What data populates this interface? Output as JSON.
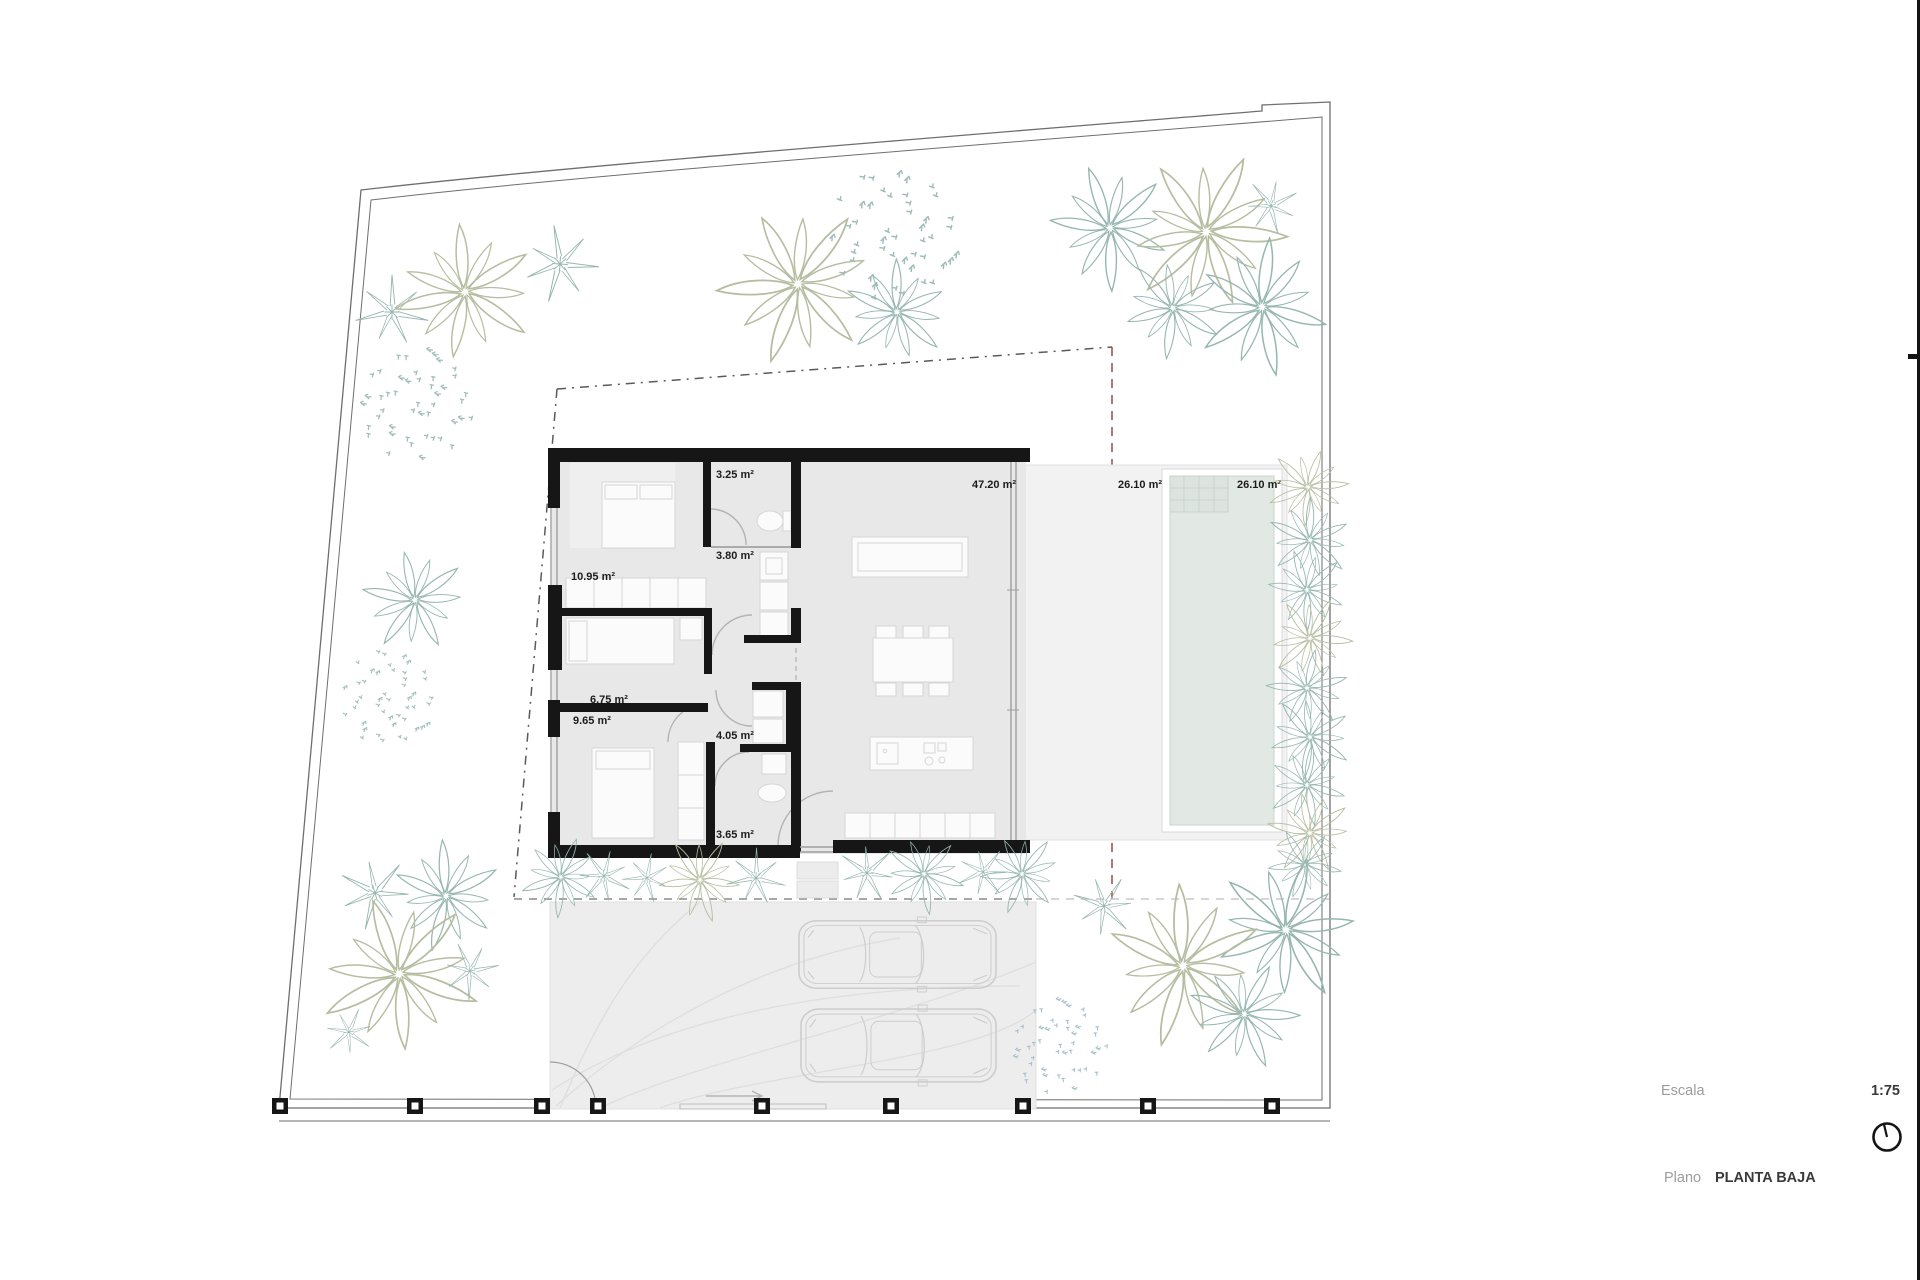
{
  "plan": {
    "room_labels": {
      "bedroom1": "10.95 m²",
      "bath1": "3.25 m²",
      "hall": "3.80 m²",
      "bedroom2": "6.75 m²",
      "bedroom3": "9.65 m²",
      "bath2": "4.05 m²",
      "bath3": "3.65 m²",
      "living": "47.20 m²",
      "terrace": "26.10 m²",
      "pool": "26.10 m²"
    }
  },
  "title_block": {
    "escala_label": "Escala",
    "escala_value": "1:75",
    "plano_label": "Plano",
    "plano_value": "PLANTA BAJA"
  },
  "colors": {
    "wall": "#161616",
    "room_fill": "#e8e8e8",
    "rug_fill": "#efefef",
    "terrace_fill": "#f2f2f2",
    "pool_water": "#e2e8e4",
    "pool_border": "#c9d4cd",
    "driveway_fill": "#ededed",
    "furniture_fill": "#fbfbfb",
    "furniture_stroke": "#d6d6d6",
    "door_arc": "#b3b3b3",
    "window_line": "#9e9e9e",
    "boundary": "#6e6e6e",
    "setback_dash": "#5a5a5a",
    "setback_dash_red": "#9a4a43",
    "setback_dash_light": "#c9c9c9",
    "car_outline": "#cdcdcd",
    "drive_guide": "#dedede",
    "tree_olive": "#b6bda0",
    "tree_teal": "#96b6b0",
    "shrub_teal": "#9fbcba",
    "shrub_blue": "#a4bfca",
    "muted_text": "#9c9c9c",
    "dark_text": "#3a3a3a"
  },
  "fence_posts": {
    "y": 1106,
    "xs": [
      280,
      415,
      542,
      598,
      762,
      891,
      1023,
      1148,
      1272
    ]
  },
  "cars": [
    {
      "x": 798,
      "y": 917,
      "w": 199,
      "h": 75
    },
    {
      "x": 800,
      "y": 1005,
      "w": 197,
      "h": 81
    }
  ],
  "trees": [
    {
      "type": "star",
      "x": 392,
      "y": 312,
      "r": 42,
      "color": "teal"
    },
    {
      "type": "palm",
      "x": 465,
      "y": 292,
      "r": 70,
      "color": "olive"
    },
    {
      "type": "star",
      "x": 560,
      "y": 264,
      "r": 44,
      "color": "teal"
    },
    {
      "type": "shrub",
      "x": 418,
      "y": 402,
      "r": 62,
      "color": "shrub_teal"
    },
    {
      "type": "palm",
      "x": 798,
      "y": 284,
      "r": 80,
      "color": "olive"
    },
    {
      "type": "shrub",
      "x": 897,
      "y": 237,
      "r": 72,
      "color": "shrub_teal"
    },
    {
      "type": "palm",
      "x": 897,
      "y": 312,
      "r": 52,
      "color": "teal"
    },
    {
      "type": "palm",
      "x": 1110,
      "y": 228,
      "r": 62,
      "color": "teal"
    },
    {
      "type": "palm",
      "x": 1206,
      "y": 232,
      "r": 80,
      "color": "olive"
    },
    {
      "type": "star",
      "x": 1271,
      "y": 206,
      "r": 32,
      "color": "teal"
    },
    {
      "type": "palm",
      "x": 1173,
      "y": 308,
      "r": 50,
      "color": "teal"
    },
    {
      "type": "palm",
      "x": 1262,
      "y": 307,
      "r": 68,
      "color": "teal"
    },
    {
      "type": "palm",
      "x": 415,
      "y": 600,
      "r": 52,
      "color": "teal"
    },
    {
      "type": "shrub",
      "x": 390,
      "y": 700,
      "r": 52,
      "color": "shrub_teal"
    },
    {
      "type": "star",
      "x": 375,
      "y": 893,
      "r": 42,
      "color": "teal"
    },
    {
      "type": "palm",
      "x": 446,
      "y": 896,
      "r": 55,
      "color": "teal"
    },
    {
      "type": "palm",
      "x": 399,
      "y": 974,
      "r": 80,
      "color": "olive"
    },
    {
      "type": "star",
      "x": 470,
      "y": 971,
      "r": 33,
      "color": "teal"
    },
    {
      "type": "star",
      "x": 349,
      "y": 1032,
      "r": 28,
      "color": "teal"
    },
    {
      "type": "palm",
      "x": 561,
      "y": 877,
      "r": 40,
      "color": "teal"
    },
    {
      "type": "star",
      "x": 604,
      "y": 876,
      "r": 32,
      "color": "teal"
    },
    {
      "type": "star",
      "x": 647,
      "y": 878,
      "r": 28,
      "color": "teal"
    },
    {
      "type": "palm",
      "x": 700,
      "y": 880,
      "r": 42,
      "color": "olive"
    },
    {
      "type": "star",
      "x": 756,
      "y": 878,
      "r": 34,
      "color": "teal"
    },
    {
      "type": "star",
      "x": 867,
      "y": 873,
      "r": 34,
      "color": "teal"
    },
    {
      "type": "palm",
      "x": 924,
      "y": 874,
      "r": 40,
      "color": "teal"
    },
    {
      "type": "star",
      "x": 983,
      "y": 872,
      "r": 30,
      "color": "teal"
    },
    {
      "type": "palm",
      "x": 1022,
      "y": 874,
      "r": 40,
      "color": "teal"
    },
    {
      "type": "palm",
      "x": 1308,
      "y": 487,
      "r": 40,
      "color": "olive"
    },
    {
      "type": "palm",
      "x": 1310,
      "y": 540,
      "r": 42,
      "color": "teal"
    },
    {
      "type": "palm",
      "x": 1307,
      "y": 590,
      "r": 40,
      "color": "teal"
    },
    {
      "type": "palm",
      "x": 1310,
      "y": 638,
      "r": 42,
      "color": "olive"
    },
    {
      "type": "palm",
      "x": 1307,
      "y": 688,
      "r": 40,
      "color": "teal"
    },
    {
      "type": "palm",
      "x": 1310,
      "y": 737,
      "r": 42,
      "color": "teal"
    },
    {
      "type": "palm",
      "x": 1307,
      "y": 785,
      "r": 40,
      "color": "teal"
    },
    {
      "type": "palm",
      "x": 1310,
      "y": 833,
      "r": 42,
      "color": "olive"
    },
    {
      "type": "palm",
      "x": 1305,
      "y": 864,
      "r": 36,
      "color": "teal"
    },
    {
      "type": "palm",
      "x": 1286,
      "y": 930,
      "r": 72,
      "color": "teal"
    },
    {
      "type": "palm",
      "x": 1183,
      "y": 966,
      "r": 80,
      "color": "olive"
    },
    {
      "type": "star",
      "x": 1104,
      "y": 906,
      "r": 36,
      "color": "teal"
    },
    {
      "type": "palm",
      "x": 1244,
      "y": 1014,
      "r": 55,
      "color": "teal"
    },
    {
      "type": "shrub",
      "x": 1060,
      "y": 1044,
      "r": 52,
      "color": "shrub_blue"
    }
  ]
}
